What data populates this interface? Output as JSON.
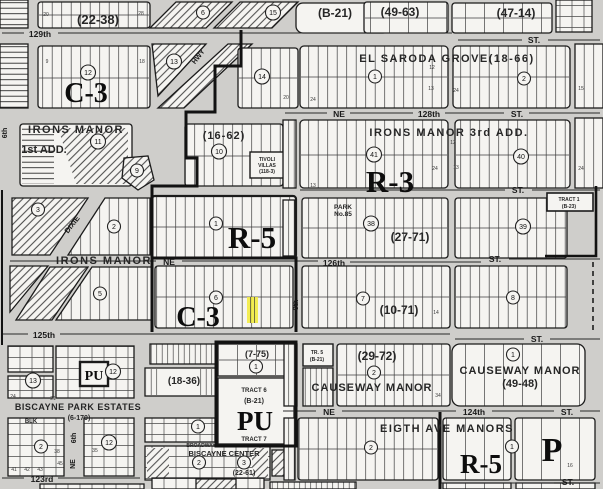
{
  "map": {
    "colors": {
      "street_background": "#cfcecb",
      "block_paper": "#f5f4f1",
      "ink": "#1b1b1b",
      "highlight_yellow": "#f2ec3d"
    },
    "zone_labels": [
      {
        "name": "zone-c3-north",
        "text": "C-3",
        "x": 86,
        "y": 102,
        "fs": 28
      },
      {
        "name": "zone-r3",
        "text": "R-3",
        "x": 390,
        "y": 192,
        "fs": 31
      },
      {
        "name": "zone-r5-mid",
        "text": "R-5",
        "x": 252,
        "y": 248,
        "fs": 31
      },
      {
        "name": "zone-c3-south",
        "text": "C-3",
        "x": 198,
        "y": 326,
        "fs": 28
      },
      {
        "name": "zone-r5-bottom",
        "text": "R-5",
        "x": 481,
        "y": 473,
        "fs": 27
      },
      {
        "name": "zone-p",
        "text": "P",
        "x": 552,
        "y": 461,
        "fs": 34
      },
      {
        "name": "zone-pu-small",
        "text": "PU",
        "x": 94,
        "y": 380,
        "fs": 14
      },
      {
        "name": "zone-pu-large",
        "text": "PU",
        "x": 255,
        "y": 430,
        "fs": 27
      }
    ],
    "subdivision_labels": [
      {
        "name": "plat-22-38",
        "text": "(22-38)",
        "x": 98,
        "y": 24,
        "fs": 13
      },
      {
        "name": "plat-b-21",
        "text": "(B-21)",
        "x": 335,
        "y": 17,
        "fs": 12
      },
      {
        "name": "plat-49-63",
        "text": "(49-63)",
        "x": 400,
        "y": 16,
        "fs": 12
      },
      {
        "name": "plat-47-14",
        "text": "(47-14)",
        "x": 516,
        "y": 17,
        "fs": 12
      },
      {
        "name": "el-saroda-grove",
        "text": "EL SARODA GROVE(18-66)",
        "x": 447,
        "y": 62,
        "fs": 11,
        "ls": 1.5
      },
      {
        "name": "irons-manor",
        "text": "IRONS MANOR",
        "x": 76,
        "y": 133,
        "fs": 11,
        "ls": 1.5
      },
      {
        "name": "irons-manor-1st-add",
        "text": "1st ADD.",
        "x": 44,
        "y": 153,
        "fs": 11
      },
      {
        "name": "plat-16-62",
        "text": "(16-62)",
        "x": 224,
        "y": 139,
        "fs": 11,
        "ls": 1
      },
      {
        "name": "tivoli-villas-1",
        "text": "TIVOLI",
        "x": 267,
        "y": 161,
        "fs": 5
      },
      {
        "name": "tivoli-villas-2",
        "text": "VILLAS",
        "x": 267,
        "y": 167,
        "fs": 5
      },
      {
        "name": "tivoli-villas-3",
        "text": "(118-3)",
        "x": 267,
        "y": 173,
        "fs": 5
      },
      {
        "name": "irons-manor-3rd-add",
        "text": "IRONS MANOR 3rd ADD.",
        "x": 449,
        "y": 136,
        "fs": 11,
        "ls": 1.5
      },
      {
        "name": "park-name",
        "text": "PARK",
        "x": 343,
        "y": 209,
        "fs": 6.5
      },
      {
        "name": "park-number",
        "text": "No.85",
        "x": 343,
        "y": 216,
        "fs": 6.5
      },
      {
        "name": "plat-27-71",
        "text": "(27-71)",
        "x": 410,
        "y": 241,
        "fs": 12
      },
      {
        "name": "irons-manor-south",
        "text": "IRONS MANOR",
        "x": 104,
        "y": 264,
        "fs": 11,
        "ls": 1.5
      },
      {
        "name": "plat-10-71",
        "text": "(10-71)",
        "x": 399,
        "y": 314,
        "fs": 12
      },
      {
        "name": "plat-7-75",
        "text": "(7-75)",
        "x": 257,
        "y": 357,
        "fs": 9
      },
      {
        "name": "tr-5",
        "text": "TR. 5",
        "x": 317,
        "y": 354,
        "fs": 5
      },
      {
        "name": "tr-5-plat",
        "text": "(B-21)",
        "x": 317,
        "y": 361,
        "fs": 5
      },
      {
        "name": "plat-29-72",
        "text": "(29-72)",
        "x": 377,
        "y": 360,
        "fs": 12
      },
      {
        "name": "causeway-manor-south",
        "text": "CAUSEWAY MANOR",
        "x": 372,
        "y": 391,
        "fs": 11,
        "ls": 1
      },
      {
        "name": "causeway-manor",
        "text": "CAUSEWAY MANOR",
        "x": 520,
        "y": 374,
        "fs": 11,
        "ls": 1
      },
      {
        "name": "plat-49-48",
        "text": "(49-48)",
        "x": 520,
        "y": 387,
        "fs": 11
      },
      {
        "name": "tract-6",
        "text": "TRACT 6",
        "x": 254,
        "y": 392,
        "fs": 6
      },
      {
        "name": "tract-6-plat",
        "text": "(B-21)",
        "x": 254,
        "y": 403,
        "fs": 7
      },
      {
        "name": "tract-7",
        "text": "TRACT 7",
        "x": 254,
        "y": 441,
        "fs": 6
      },
      {
        "name": "biscayne-park-estates",
        "text": "BISCAYNE PARK ESTATES",
        "x": 78,
        "y": 410,
        "fs": 9,
        "ls": 0.5
      },
      {
        "name": "plat-6-170",
        "text": "(6-170)",
        "x": 79,
        "y": 420,
        "fs": 7
      },
      {
        "name": "blk-label",
        "text": "BLK",
        "x": 31,
        "y": 423,
        "fs": 6
      },
      {
        "name": "plat-18-36",
        "text": "(18-36)",
        "x": 184,
        "y": 384,
        "fs": 10
      },
      {
        "name": "eigth-ave-manors",
        "text": "EIGTH AVE MANORS",
        "x": 447,
        "y": 432,
        "fs": 11,
        "ls": 1.5
      },
      {
        "name": "biscayne-center",
        "text": "BISCAYNE CENTER",
        "x": 224,
        "y": 456,
        "fs": 7.5
      },
      {
        "name": "plat-22-61",
        "text": "(22-61)",
        "x": 244,
        "y": 475,
        "fs": 7
      },
      {
        "name": "tract-1",
        "text": "TRACT 1",
        "x": 569,
        "y": 201,
        "fs": 5
      },
      {
        "name": "tract-1-plat",
        "text": "(B-23)",
        "x": 569,
        "y": 208,
        "fs": 5
      },
      {
        "name": "broadway",
        "text": "BROADWAY",
        "x": 201,
        "y": 447,
        "fs": 5
      }
    ],
    "street_labels": [
      {
        "name": "st-129th",
        "text": "129th",
        "x": 40,
        "y": 37,
        "fs": 8.5
      },
      {
        "name": "st-top-right",
        "text": "ST.",
        "x": 534,
        "y": 43,
        "fs": 8.5
      },
      {
        "name": "st-ne-128",
        "text": "NE",
        "x": 339,
        "y": 117,
        "fs": 8.5
      },
      {
        "name": "st-128th",
        "text": "128th",
        "x": 429,
        "y": 117,
        "fs": 8.5
      },
      {
        "name": "st-128-st",
        "text": "ST.",
        "x": 517,
        "y": 117,
        "fs": 8.5
      },
      {
        "name": "st-mid-right",
        "text": "ST.",
        "x": 518,
        "y": 193,
        "fs": 8.5
      },
      {
        "name": "st-ne-126",
        "text": "NE",
        "x": 169,
        "y": 265,
        "fs": 8.5
      },
      {
        "name": "st-126th",
        "text": "126th",
        "x": 334,
        "y": 266,
        "fs": 8.5
      },
      {
        "name": "st-126-st",
        "text": "ST.",
        "x": 495,
        "y": 262,
        "fs": 8.5
      },
      {
        "name": "st-125th",
        "text": "125th",
        "x": 44,
        "y": 338,
        "fs": 8.5
      },
      {
        "name": "st-125-st",
        "text": "ST.",
        "x": 537,
        "y": 342,
        "fs": 8.5
      },
      {
        "name": "st-ne-124",
        "text": "NE",
        "x": 329,
        "y": 415,
        "fs": 8.5
      },
      {
        "name": "st-124th",
        "text": "124th",
        "x": 474,
        "y": 415,
        "fs": 8.5
      },
      {
        "name": "st-124-st",
        "text": "ST.",
        "x": 567,
        "y": 415,
        "fs": 8.5
      },
      {
        "name": "st-123rd",
        "text": "123rd",
        "x": 42,
        "y": 482,
        "fs": 8.5
      },
      {
        "name": "st-bottom-right",
        "text": "ST.",
        "x": 568,
        "y": 485,
        "fs": 8.5
      },
      {
        "name": "st-hwy",
        "text": "HWY",
        "x": 200,
        "y": 58,
        "fs": 7,
        "rot": -52
      },
      {
        "name": "st-dixie",
        "text": "DIXIE",
        "x": 74,
        "y": 226,
        "fs": 7.5,
        "rot": -52
      },
      {
        "name": "st-6th-left",
        "text": "6th",
        "x": 7,
        "y": 133,
        "fs": 7,
        "rot": -90
      },
      {
        "name": "st-8th",
        "text": "8th",
        "x": 298,
        "y": 305,
        "fs": 7,
        "rot": -90
      },
      {
        "name": "st-6th-bottom",
        "text": "6th",
        "x": 76,
        "y": 438,
        "fs": 7,
        "rot": -90
      },
      {
        "name": "st-ne-bottom",
        "text": "NE",
        "x": 75,
        "y": 464,
        "fs": 7,
        "rot": -90
      }
    ],
    "block_numbers": [
      {
        "n": "6",
        "x": 203,
        "y": 15
      },
      {
        "n": "15",
        "x": 273,
        "y": 15
      },
      {
        "n": "12",
        "x": 88,
        "y": 75
      },
      {
        "n": "13",
        "x": 174,
        "y": 64
      },
      {
        "n": "14",
        "x": 262,
        "y": 79
      },
      {
        "n": "11",
        "x": 98,
        "y": 144
      },
      {
        "n": "10",
        "x": 219,
        "y": 154
      },
      {
        "n": "9",
        "x": 137,
        "y": 173
      },
      {
        "n": "3",
        "x": 38,
        "y": 212
      },
      {
        "n": "2",
        "x": 114,
        "y": 229
      },
      {
        "n": "1",
        "x": 375,
        "y": 79
      },
      {
        "n": "2",
        "x": 524,
        "y": 81
      },
      {
        "n": "41",
        "x": 374,
        "y": 157
      },
      {
        "n": "40",
        "x": 521,
        "y": 159
      },
      {
        "n": "38",
        "x": 371,
        "y": 226
      },
      {
        "n": "39",
        "x": 523,
        "y": 229
      },
      {
        "n": "1",
        "x": 216,
        "y": 226
      },
      {
        "n": "5",
        "x": 100,
        "y": 296
      },
      {
        "n": "6",
        "x": 216,
        "y": 300
      },
      {
        "n": "7",
        "x": 363,
        "y": 301
      },
      {
        "n": "8",
        "x": 513,
        "y": 300
      },
      {
        "n": "1",
        "x": 256,
        "y": 369
      },
      {
        "n": "2",
        "x": 374,
        "y": 375
      },
      {
        "n": "1",
        "x": 513,
        "y": 357
      },
      {
        "n": "13",
        "x": 33,
        "y": 383
      },
      {
        "n": "12",
        "x": 113,
        "y": 374
      },
      {
        "n": "2",
        "x": 41,
        "y": 449
      },
      {
        "n": "12",
        "x": 109,
        "y": 445
      },
      {
        "n": "1",
        "x": 198,
        "y": 429
      },
      {
        "n": "2",
        "x": 199,
        "y": 465
      },
      {
        "n": "3",
        "x": 244,
        "y": 465
      },
      {
        "n": "2",
        "x": 371,
        "y": 450
      },
      {
        "n": "1",
        "x": 512,
        "y": 449
      }
    ],
    "lot_numbers": [
      {
        "t": "20",
        "x": 46,
        "y": 16
      },
      {
        "t": "28",
        "x": 141,
        "y": 15
      },
      {
        "t": "9",
        "x": 47,
        "y": 63
      },
      {
        "t": "18",
        "x": 142,
        "y": 63
      },
      {
        "t": "20",
        "x": 286,
        "y": 99
      },
      {
        "t": "12",
        "x": 432,
        "y": 69
      },
      {
        "t": "13",
        "x": 431,
        "y": 90
      },
      {
        "t": "24",
        "x": 456,
        "y": 92
      },
      {
        "t": "15",
        "x": 581,
        "y": 90
      },
      {
        "t": "24",
        "x": 313,
        "y": 101
      },
      {
        "t": "12",
        "x": 453,
        "y": 144
      },
      {
        "t": "13",
        "x": 313,
        "y": 187
      },
      {
        "t": "24",
        "x": 435,
        "y": 170
      },
      {
        "t": "13",
        "x": 456,
        "y": 169
      },
      {
        "t": "24",
        "x": 581,
        "y": 170
      },
      {
        "t": "14",
        "x": 436,
        "y": 314
      },
      {
        "t": "34",
        "x": 438,
        "y": 397
      },
      {
        "t": "41",
        "x": 14,
        "y": 471
      },
      {
        "t": "42",
        "x": 27,
        "y": 471
      },
      {
        "t": "43",
        "x": 40,
        "y": 471
      },
      {
        "t": "45",
        "x": 60,
        "y": 465
      },
      {
        "t": "38",
        "x": 57,
        "y": 453
      },
      {
        "t": "35",
        "x": 95,
        "y": 452
      },
      {
        "t": "33",
        "x": 112,
        "y": 442
      },
      {
        "t": "16",
        "x": 570,
        "y": 467
      },
      {
        "t": "21",
        "x": 53,
        "y": 400
      },
      {
        "t": "24",
        "x": 13,
        "y": 398
      }
    ]
  }
}
